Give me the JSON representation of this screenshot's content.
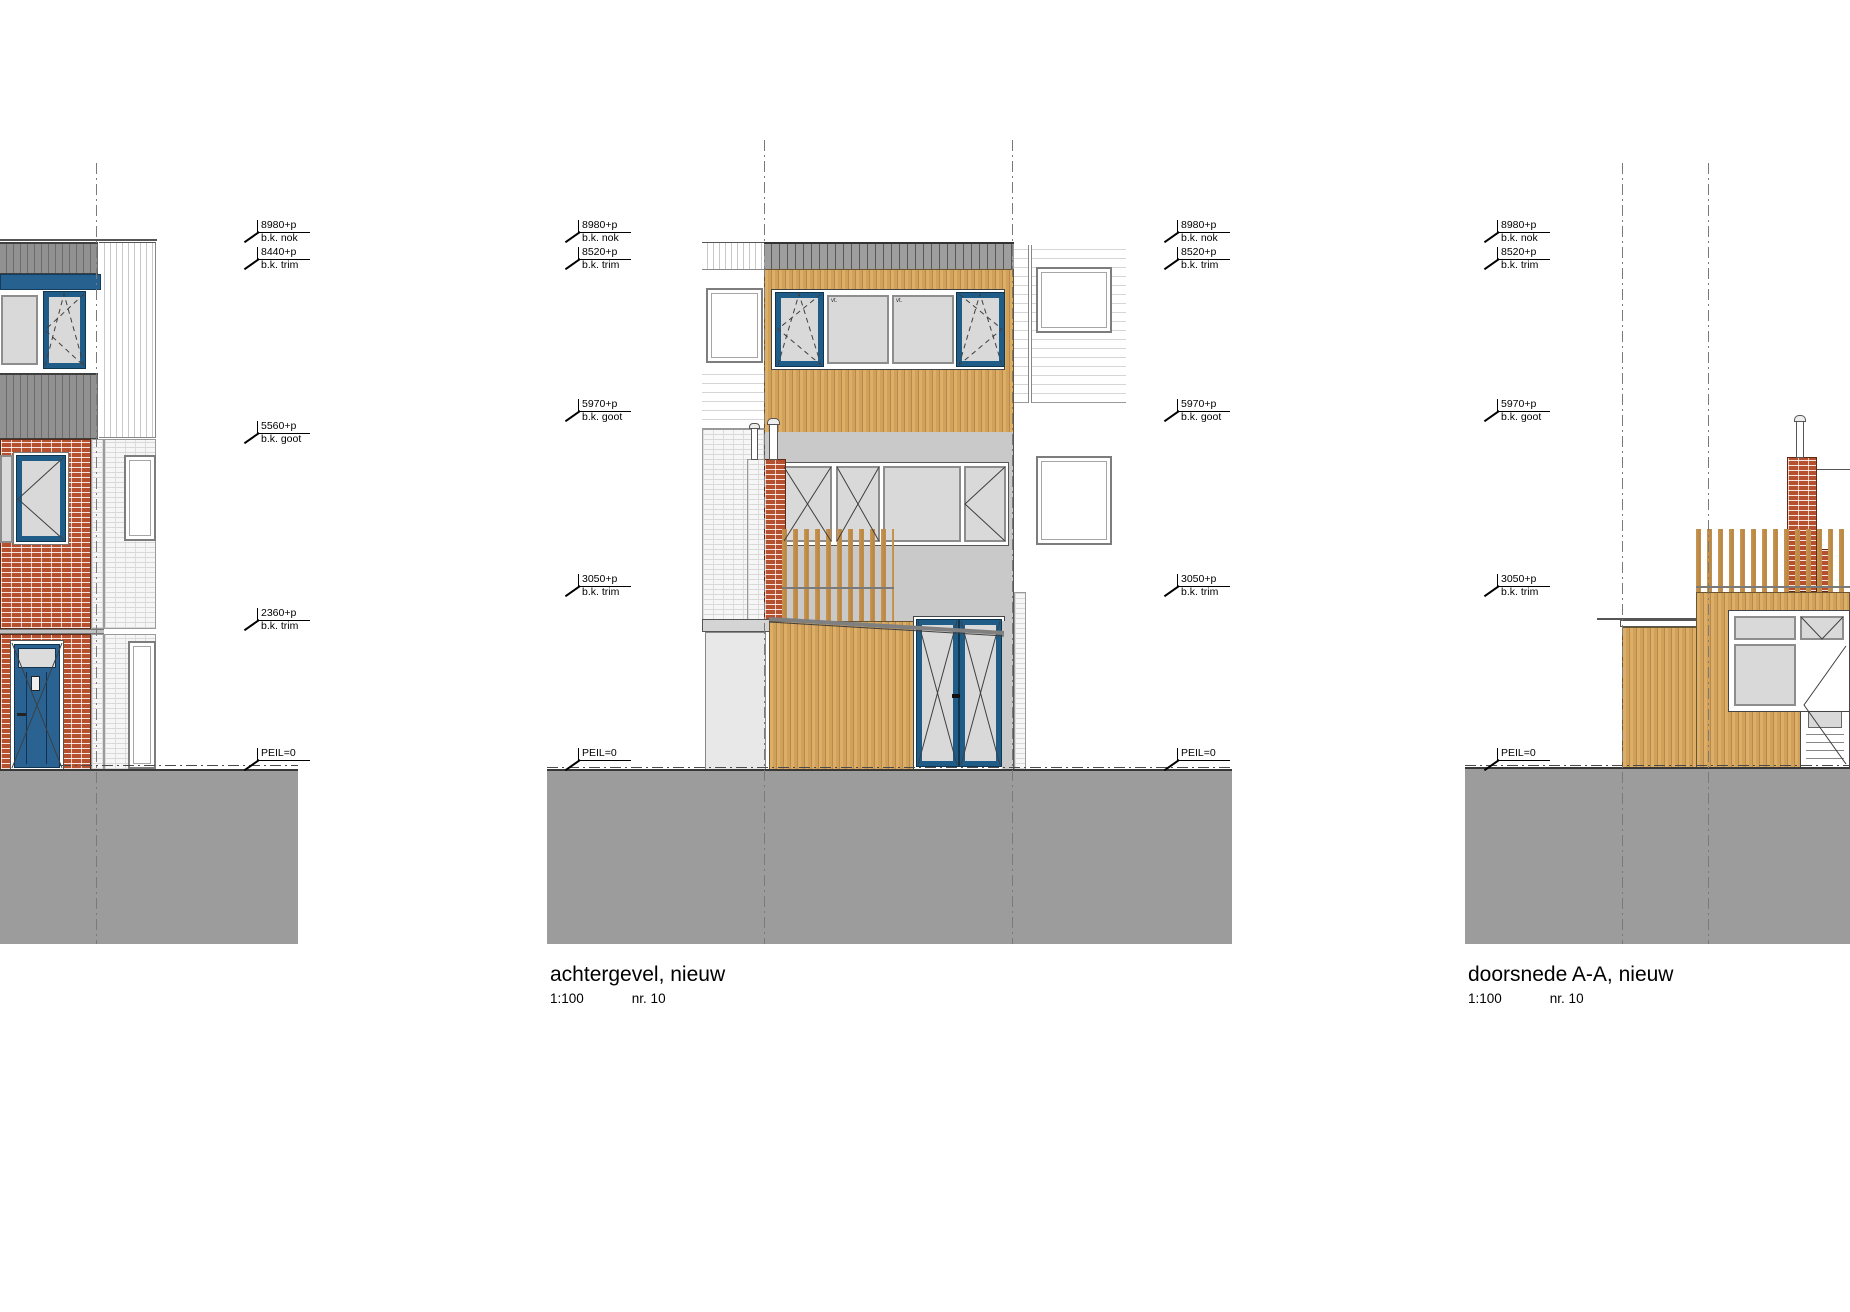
{
  "drawing_titles": {
    "rear_facade": {
      "title": "achtergevel, nieuw",
      "scale": "1:100",
      "sheet": "nr. 10"
    },
    "section": {
      "title": "doorsnede A-A, nieuw",
      "scale": "1:100",
      "sheet": "nr. 10"
    }
  },
  "level_markers": {
    "left_building": [
      {
        "value": "8980+p",
        "ref": "b.k. nok"
      },
      {
        "value": "8440+p",
        "ref": "b.k. trim"
      },
      {
        "value": "5560+p",
        "ref": "b.k. goot"
      },
      {
        "value": "2360+p",
        "ref": "b.k. trim"
      },
      {
        "value": "PEIL=0",
        "ref": ""
      }
    ],
    "rear_facade_left": [
      {
        "value": "8980+p",
        "ref": "b.k. nok"
      },
      {
        "value": "8520+p",
        "ref": "b.k. trim"
      },
      {
        "value": "5970+p",
        "ref": "b.k. goot"
      },
      {
        "value": "3050+p",
        "ref": "b.k. trim"
      },
      {
        "value": "PEIL=0",
        "ref": ""
      }
    ],
    "rear_facade_right": [
      {
        "value": "8980+p",
        "ref": "b.k. nok"
      },
      {
        "value": "8520+p",
        "ref": "b.k. trim"
      },
      {
        "value": "5970+p",
        "ref": "b.k. goot"
      },
      {
        "value": "3050+p",
        "ref": "b.k. trim"
      },
      {
        "value": "PEIL=0",
        "ref": ""
      }
    ],
    "section": [
      {
        "value": "8980+p",
        "ref": "b.k. nok"
      },
      {
        "value": "8520+p",
        "ref": "b.k. trim"
      },
      {
        "value": "5970+p",
        "ref": "b.k. goot"
      },
      {
        "value": "3050+p",
        "ref": "b.k. trim"
      },
      {
        "value": "PEIL=0",
        "ref": ""
      }
    ]
  },
  "window_codes": {
    "fixed_pane": "vt."
  },
  "colors": {
    "wood_cladding": "#d3a057",
    "red_brick": "#b5512e",
    "frame_blue": "#1f5c88",
    "roof_trim_gray": "#9e9e9e",
    "stucco_gray": "#c9c9c9",
    "glass_gray": "#d9d9d9",
    "ground_gray": "#9c9c9c"
  }
}
